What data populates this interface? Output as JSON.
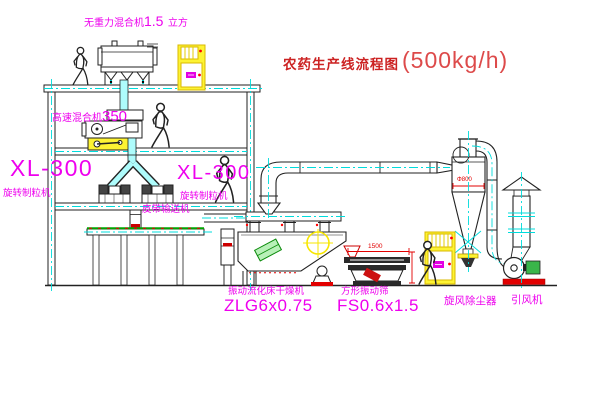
{
  "title": {
    "name": "农药生产线流程图",
    "capacity": "(500kg/h)"
  },
  "labels": {
    "gravity_mixer": {
      "name": "无重力混合机",
      "size": "1.5",
      "unit": "立方"
    },
    "high_speed_mixer": {
      "name": "高速混合机",
      "model": "350"
    },
    "granulator_left": {
      "model": "XL-300",
      "name": "旋转制粒机"
    },
    "granulator_right": {
      "model": "XL-300",
      "name": "旋转制粒机"
    },
    "belt_conveyor": "皮带输送机",
    "dryer": {
      "name": "振动流化床干燥机",
      "model": "ZLG6x0.75"
    },
    "screen": {
      "name": "方形振动筛",
      "model": "FS0.6x1.5"
    },
    "cyclone": "旋风除尘器",
    "fan": "引风机"
  },
  "dimensions": {
    "cyclone_diameter": "Φ800",
    "screen_length": "1500"
  },
  "colors": {
    "label_magenta": "#ee00ee",
    "title_red": "#cc2222",
    "dimension_red": "#e20000",
    "centerline_cyan": "#00dcdc",
    "cabinet_yellow": "#fdf333",
    "conveyor_green": "#00a400"
  }
}
